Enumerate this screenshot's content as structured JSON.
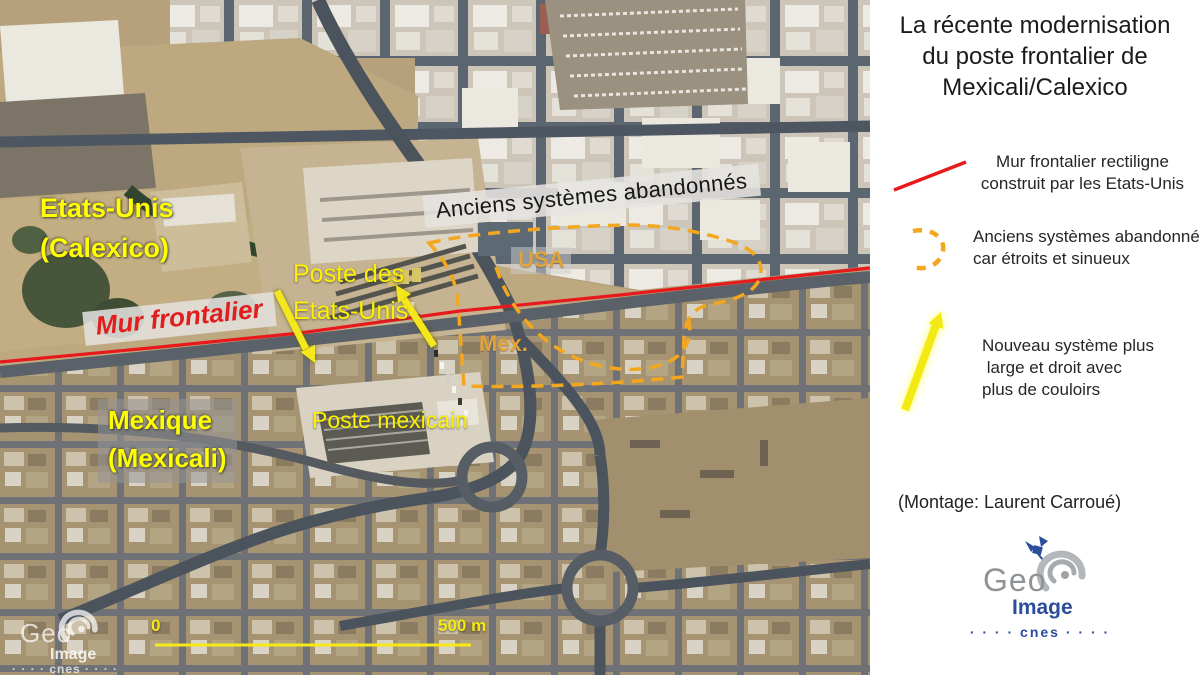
{
  "sidebar": {
    "title_lines": [
      "La récente modernisation",
      "du poste frontalier de",
      "Mexicali/Calexico"
    ],
    "legend": [
      {
        "symbol": "red-line-icon",
        "lines": [
          "Mur frontalier rectiligne",
          "construit par les Etats-Unis"
        ]
      },
      {
        "symbol": "orange-dashed-arc-icon",
        "lines": [
          "Anciens systèmes abandonnés",
          "car étroits et sinueux"
        ]
      },
      {
        "symbol": "yellow-arrow-icon",
        "lines": [
          "Nouveau système plus",
          " large et droit avec",
          "plus de couloirs"
        ]
      }
    ],
    "credit": "(Montage: Laurent Carroué)",
    "logo": {
      "geo": "Geo",
      "image": "Image",
      "cnes": "cnes",
      "dots": "· · · ·"
    }
  },
  "map": {
    "labels": {
      "country_us_line1": "Etats-Unis",
      "country_us_line2": "(Calexico)",
      "border_wall": "Mur frontalier",
      "abandoned_systems": "Anciens systèmes abandonnés",
      "usa": "USA",
      "mex": "Mex.",
      "us_post_line1": "Poste des",
      "us_post_line2": "Etats-Unis",
      "mx_post": "Poste mexicain",
      "country_mx_line1": "Mexique",
      "country_mx_line2": "(Mexicali)"
    },
    "scale_bar": {
      "start": "0",
      "end": "500 m"
    },
    "watermark": {
      "geo": "Geo",
      "image": "Image",
      "cnes": "cnes",
      "dots": "· · · ·"
    },
    "colors": {
      "border_wall_red": "#e8191c",
      "abandoned_dashed_orange": "#f2a71e",
      "new_system_yellow": "#f4e71c",
      "place_label_yellow": "#ffff00",
      "usa_mex_amber": "#e2a33c"
    }
  }
}
